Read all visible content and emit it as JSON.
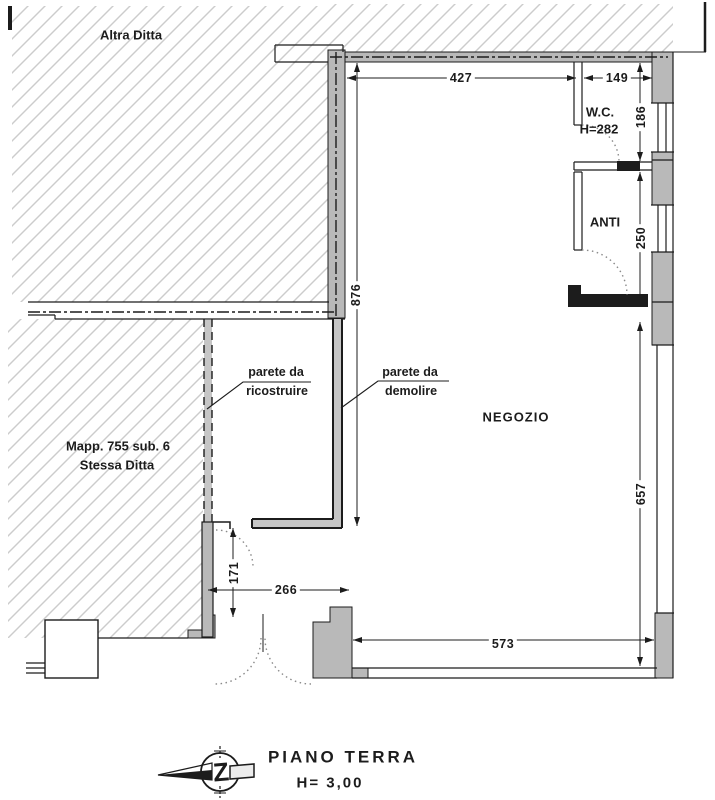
{
  "colors": {
    "wall_fill": "#b9b9b9",
    "line": "#1c1c1c",
    "hatch": "#cccccc",
    "dash_fill": "#c6c6c6",
    "background": "#ffffff",
    "arc": "#8a8a8a"
  },
  "areas": {
    "altra_ditta": "Altra Ditta",
    "mappale_line1": "Mapp. 755 sub. 6",
    "mappale_line2": "Stessa Ditta",
    "negozio": "NEGOZIO",
    "wc": "W.C.",
    "wc_height": "H=282",
    "anti": "ANTI"
  },
  "annotations": {
    "rebuild_line1": "parete da",
    "rebuild_line2": "ricostruire",
    "demolish_line1": "parete da",
    "demolish_line2": "demolire"
  },
  "dimensions": {
    "negozio_top": "427",
    "wc_top": "149",
    "wc_right": "186",
    "anti_right": "250",
    "right_lower": "657",
    "negozio_left": "876",
    "opening_left": "171",
    "entrance_width": "266",
    "shopfront": "573"
  },
  "title": {
    "floor": "PIANO TERRA",
    "height": "H= 3,00",
    "north_letter": "Z"
  }
}
